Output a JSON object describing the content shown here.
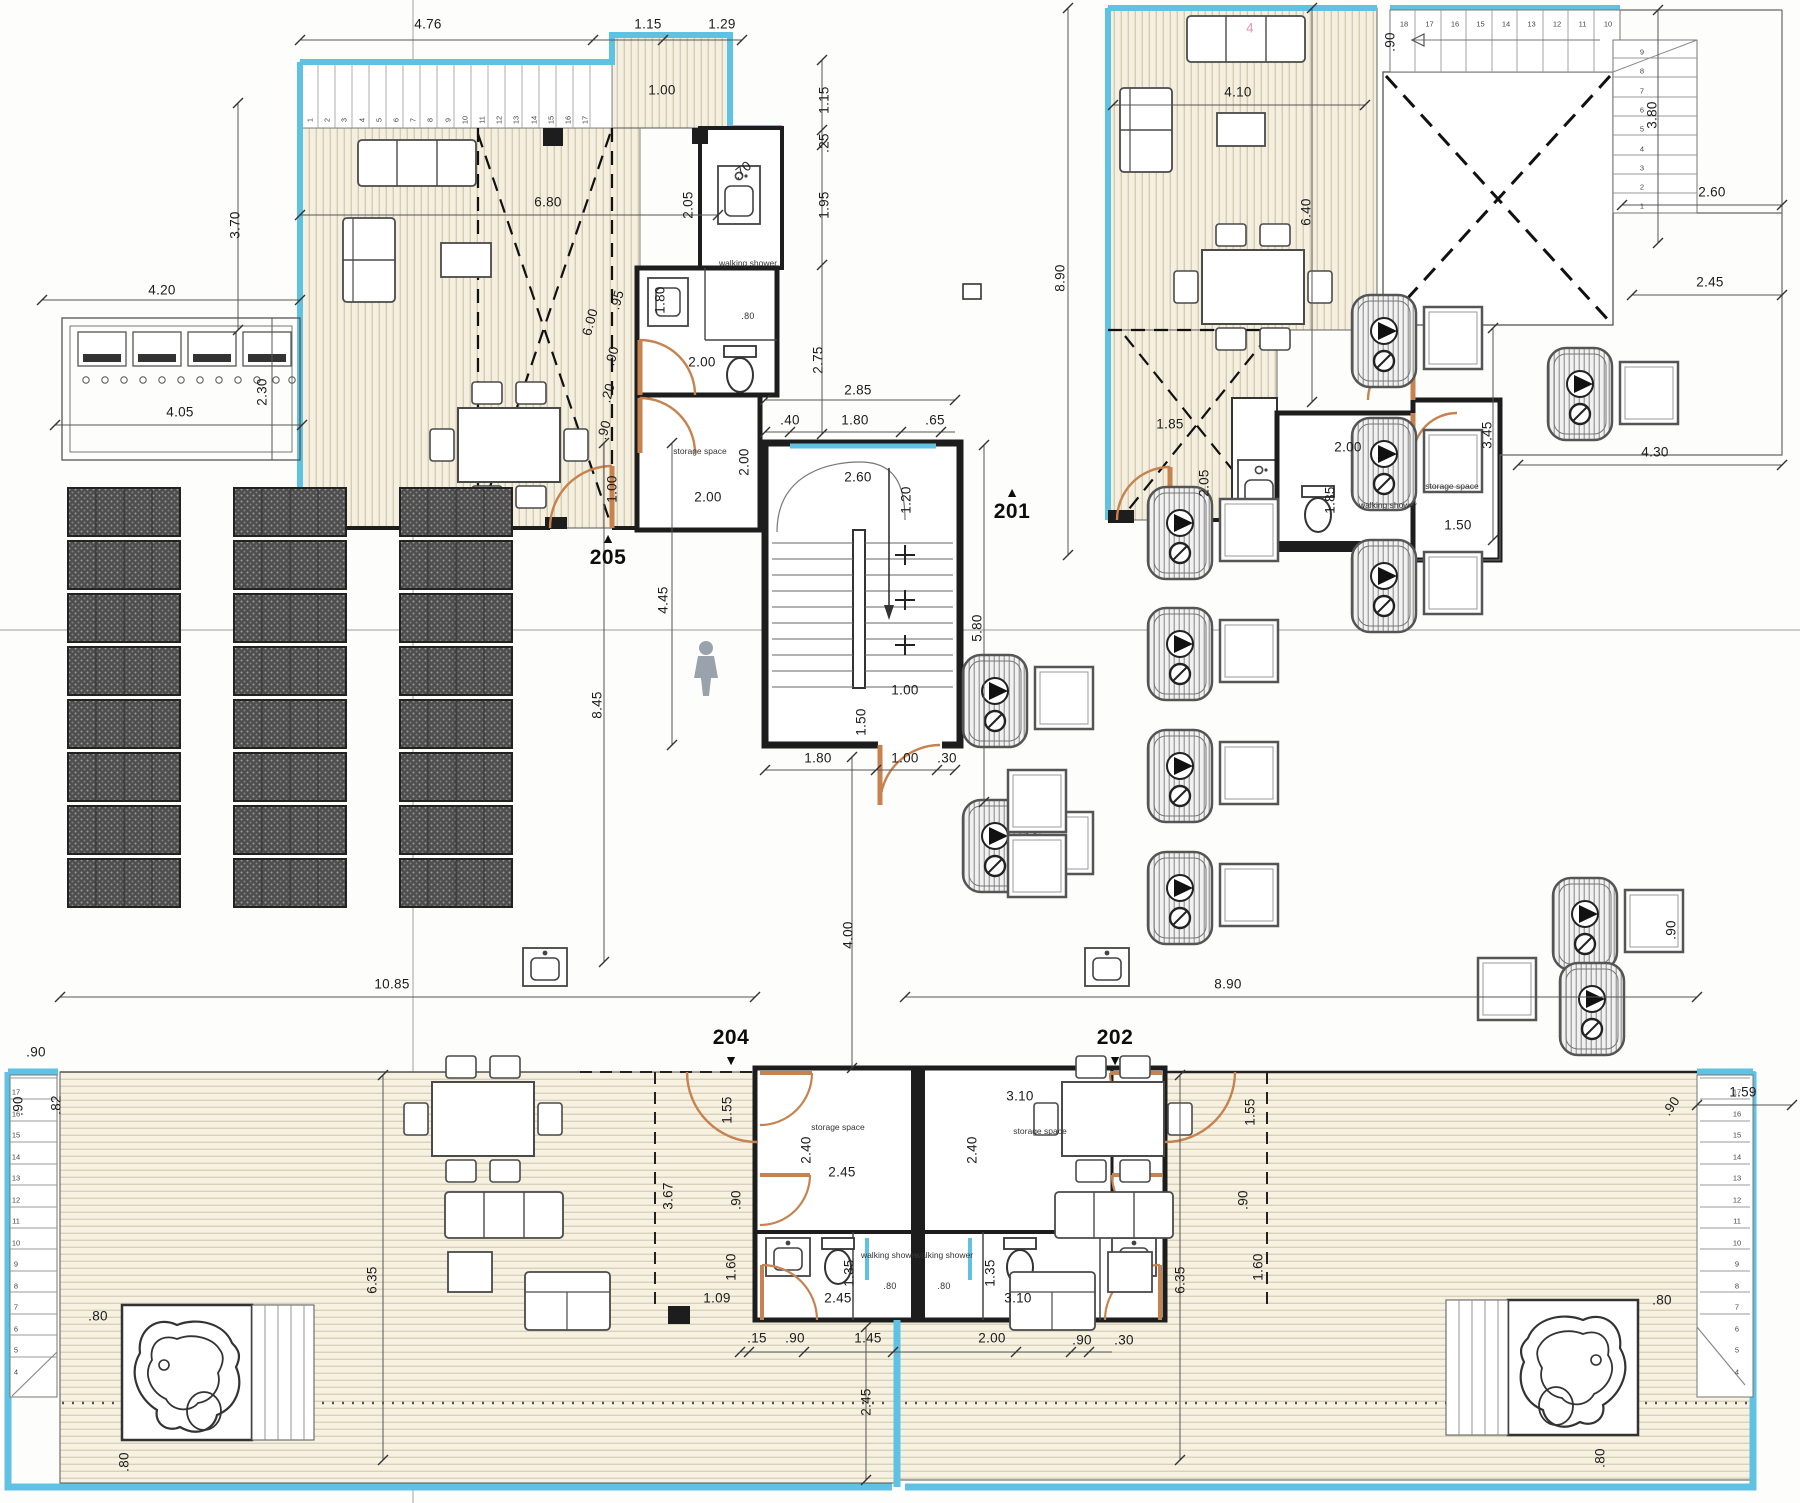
{
  "colors": {
    "cyan": "#5fc2e2",
    "deck": "#f4efdf",
    "deck_stripe": "#c6bda2",
    "wall": "#1d1d1d",
    "door_orange": "#c7834f",
    "panel_dark": "#4e4e4e",
    "dim_text": "#1c1c1c"
  },
  "unit_markers": [
    {
      "label": "205",
      "x": 608,
      "y": 558,
      "tri": "▲",
      "tx": 608,
      "ty": 538
    },
    {
      "label": "201",
      "x": 1012,
      "y": 512,
      "tri": "▲",
      "tx": 1012,
      "ty": 492
    },
    {
      "label": "204",
      "x": 731,
      "y": 1038,
      "tri": "▼",
      "tx": 731,
      "ty": 1060
    },
    {
      "label": "202",
      "x": 1115,
      "y": 1038,
      "tri": "▼",
      "tx": 1115,
      "ty": 1060
    }
  ],
  "room_labels": [
    {
      "t": "walking shower",
      "x": 748,
      "y": 264
    },
    {
      "t": "storage space",
      "x": 700,
      "y": 452
    },
    {
      "t": "walking shower",
      "x": 1388,
      "y": 506
    },
    {
      "t": "storage space",
      "x": 1452,
      "y": 487
    },
    {
      "t": "storage space",
      "x": 838,
      "y": 1128
    },
    {
      "t": "storage space",
      "x": 1040,
      "y": 1132
    },
    {
      "t": "walking shower",
      "x": 890,
      "y": 1256
    },
    {
      "t": "walking shower",
      "x": 944,
      "y": 1256
    }
  ],
  "dim_labels": [
    {
      "t": "4.76",
      "x": 428,
      "y": 24
    },
    {
      "t": "1.15",
      "x": 648,
      "y": 24
    },
    {
      "t": "1.29",
      "x": 722,
      "y": 24
    },
    {
      "t": "1.00",
      "x": 662,
      "y": 90
    },
    {
      "t": "1.15",
      "x": 824,
      "y": 100,
      "r": -90
    },
    {
      "t": ".25",
      "x": 824,
      "y": 143,
      "r": -90
    },
    {
      "t": "1.95",
      "x": 824,
      "y": 205,
      "r": -90
    },
    {
      "t": "2.75",
      "x": 818,
      "y": 360,
      "r": -90
    },
    {
      "t": ".70",
      "x": 742,
      "y": 170,
      "r": -40
    },
    {
      "t": "2.05",
      "x": 688,
      "y": 205,
      "r": -90
    },
    {
      "t": "6.80",
      "x": 548,
      "y": 202
    },
    {
      "t": "3.70",
      "x": 235,
      "y": 225,
      "r": -90
    },
    {
      "t": "4.20",
      "x": 162,
      "y": 290
    },
    {
      "t": "2.30",
      "x": 262,
      "y": 392,
      "r": -90
    },
    {
      "t": "4.05",
      "x": 180,
      "y": 412
    },
    {
      "t": "6.00",
      "x": 590,
      "y": 322,
      "r": -75
    },
    {
      "t": ".95",
      "x": 617,
      "y": 300,
      "r": -75
    },
    {
      "t": ".90",
      "x": 612,
      "y": 356,
      "r": -75
    },
    {
      "t": ".20",
      "x": 608,
      "y": 393,
      "r": -75
    },
    {
      "t": ".90",
      "x": 604,
      "y": 430,
      "r": -75
    },
    {
      "t": "1.00",
      "x": 612,
      "y": 489,
      "r": -90
    },
    {
      "t": "1.80",
      "x": 660,
      "y": 300,
      "r": -90
    },
    {
      "t": "2.00",
      "x": 702,
      "y": 362
    },
    {
      "t": ".80",
      "x": 748,
      "y": 316,
      "s": 1
    },
    {
      "t": "2.00",
      "x": 744,
      "y": 462,
      "r": -90
    },
    {
      "t": "2.00",
      "x": 708,
      "y": 497
    },
    {
      "t": "2.85",
      "x": 858,
      "y": 390
    },
    {
      "t": ".40",
      "x": 790,
      "y": 420
    },
    {
      "t": "1.80",
      "x": 855,
      "y": 420
    },
    {
      "t": ".65",
      "x": 935,
      "y": 420
    },
    {
      "t": "2.60",
      "x": 858,
      "y": 477
    },
    {
      "t": "1.20",
      "x": 906,
      "y": 500,
      "r": -90
    },
    {
      "t": "5.80",
      "x": 977,
      "y": 628,
      "r": -90
    },
    {
      "t": "4.45",
      "x": 663,
      "y": 600,
      "r": -90
    },
    {
      "t": "8.45",
      "x": 597,
      "y": 705,
      "r": -90
    },
    {
      "t": "1.50",
      "x": 861,
      "y": 722,
      "r": -90
    },
    {
      "t": "1.00",
      "x": 905,
      "y": 690
    },
    {
      "t": "1.80",
      "x": 818,
      "y": 758
    },
    {
      "t": "1.00",
      "x": 905,
      "y": 758
    },
    {
      "t": ".30",
      "x": 947,
      "y": 758
    },
    {
      "t": "4.00",
      "x": 848,
      "y": 935,
      "r": -90
    },
    {
      "t": ".90",
      "x": 1390,
      "y": 42,
      "r": -90
    },
    {
      "t": "4.10",
      "x": 1238,
      "y": 92
    },
    {
      "t": "6.40",
      "x": 1306,
      "y": 212,
      "r": -90
    },
    {
      "t": "8.90",
      "x": 1060,
      "y": 278,
      "r": -90
    },
    {
      "t": "3.80",
      "x": 1652,
      "y": 115,
      "r": -90
    },
    {
      "t": "2.60",
      "x": 1712,
      "y": 192
    },
    {
      "t": "2.45",
      "x": 1710,
      "y": 282
    },
    {
      "t": "4",
      "x": 1250,
      "y": 28,
      "c": "#e59ab0"
    },
    {
      "t": "1.85",
      "x": 1170,
      "y": 424
    },
    {
      "t": "2.05",
      "x": 1204,
      "y": 483,
      "r": -90
    },
    {
      "t": "2.00",
      "x": 1348,
      "y": 447
    },
    {
      "t": "1.85",
      "x": 1330,
      "y": 500,
      "r": -90
    },
    {
      "t": "1.50",
      "x": 1458,
      "y": 525
    },
    {
      "t": "3.45",
      "x": 1487,
      "y": 435,
      "r": -90
    },
    {
      "t": "4.30",
      "x": 1655,
      "y": 452
    },
    {
      "t": ".90",
      "x": 36,
      "y": 1052
    },
    {
      "t": ".90",
      "x": 18,
      "y": 1106,
      "r": -90
    },
    {
      "t": ".82",
      "x": 56,
      "y": 1105,
      "r": -90
    },
    {
      "t": "10.85",
      "x": 392,
      "y": 984
    },
    {
      "t": "8.90",
      "x": 1228,
      "y": 984
    },
    {
      "t": "6.35",
      "x": 372,
      "y": 1280,
      "r": -90
    },
    {
      "t": "6.35",
      "x": 1180,
      "y": 1280,
      "r": -90
    },
    {
      "t": ".80",
      "x": 98,
      "y": 1316
    },
    {
      "t": ".80",
      "x": 124,
      "y": 1462,
      "r": -90
    },
    {
      "t": ".80",
      "x": 1662,
      "y": 1300
    },
    {
      "t": ".80",
      "x": 1600,
      "y": 1458,
      "r": -90
    },
    {
      "t": "1.59",
      "x": 1743,
      "y": 1092
    },
    {
      "t": ".90",
      "x": 1671,
      "y": 1106,
      "r": -55
    },
    {
      "t": ".90",
      "x": 1671,
      "y": 930,
      "r": -90
    },
    {
      "t": ".15",
      "x": 757,
      "y": 1338
    },
    {
      "t": ".90",
      "x": 795,
      "y": 1338
    },
    {
      "t": "1.45",
      "x": 868,
      "y": 1338
    },
    {
      "t": "2.00",
      "x": 992,
      "y": 1338
    },
    {
      "t": ".90",
      "x": 1082,
      "y": 1340
    },
    {
      "t": ".30",
      "x": 1124,
      "y": 1340
    },
    {
      "t": "2.45",
      "x": 866,
      "y": 1402,
      "r": -90
    },
    {
      "t": "2.45",
      "x": 838,
      "y": 1298
    },
    {
      "t": "3.10",
      "x": 1018,
      "y": 1298
    },
    {
      "t": "1.09",
      "x": 717,
      "y": 1298
    },
    {
      "t": "1.60",
      "x": 731,
      "y": 1267,
      "r": -90
    },
    {
      "t": "1.35",
      "x": 849,
      "y": 1273,
      "r": -90
    },
    {
      "t": "1.35",
      "x": 990,
      "y": 1273,
      "r": -90
    },
    {
      "t": "1.60",
      "x": 1258,
      "y": 1267,
      "r": -90
    },
    {
      "t": ".80",
      "x": 890,
      "y": 1286,
      "s": 1
    },
    {
      "t": ".80",
      "x": 944,
      "y": 1286,
      "s": 1
    },
    {
      "t": "2.40",
      "x": 806,
      "y": 1150,
      "r": -90
    },
    {
      "t": "2.45",
      "x": 842,
      "y": 1172
    },
    {
      "t": "2.40",
      "x": 972,
      "y": 1150,
      "r": -90
    },
    {
      "t": "3.10",
      "x": 1020,
      "y": 1096
    },
    {
      "t": "1.55",
      "x": 727,
      "y": 1110,
      "r": -90
    },
    {
      "t": ".90",
      "x": 736,
      "y": 1200,
      "r": -90
    },
    {
      "t": "3.67",
      "x": 668,
      "y": 1196,
      "r": -90
    },
    {
      "t": "1.55",
      "x": 1250,
      "y": 1112,
      "r": -90
    },
    {
      "t": ".90",
      "x": 1243,
      "y": 1200,
      "r": -90
    }
  ],
  "stair_runs": [
    {
      "x": 310,
      "y": 120,
      "dx": 17.2,
      "dy": 0,
      "from": 1,
      "to": 17,
      "r": -90
    },
    {
      "x": 1404,
      "y": 24,
      "dx": 25.5,
      "dy": 0,
      "from": 18,
      "to": 10
    },
    {
      "x": 1642,
      "y": 52,
      "dx": 0,
      "dy": 19.3,
      "from": 9,
      "to": 1
    },
    {
      "x": 16,
      "y": 1092,
      "dx": 0,
      "dy": 21.5,
      "from": 17,
      "to": 4
    },
    {
      "x": 1737,
      "y": 1092,
      "dx": 0,
      "dy": 21.5,
      "from": 17,
      "to": 4
    }
  ]
}
